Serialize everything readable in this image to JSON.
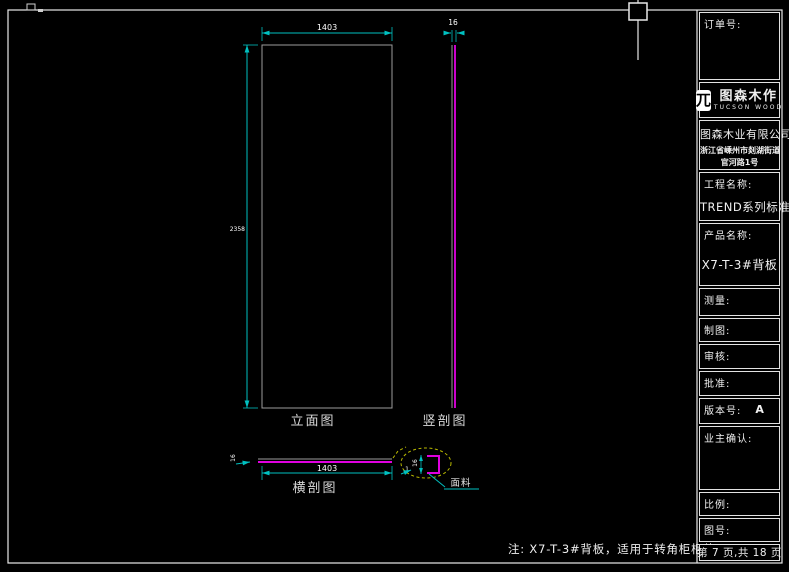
{
  "title_block": {
    "order_label": "订单号:",
    "brand_cn": "图森木作",
    "brand_en": "TUCSON WOOD",
    "logo_glyph": "兀",
    "company_name": "图森木业有限公司",
    "company_address_line1": "浙江省嵊州市剡湖街道",
    "company_address_line2": "官河路1号",
    "project_label": "工程名称:",
    "project_value": "TREND系列标准图",
    "product_label": "产品名称:",
    "product_value": "X7-T-3#背板",
    "measure_label": "测量:",
    "draft_label": "制图:",
    "review_label": "审核:",
    "approve_label": "批准:",
    "version_label": "版本号:",
    "version_value": "A",
    "owner_confirm_label": "业主确认:",
    "scale_label": "比例:",
    "drawing_no_label": "图号:",
    "page_info": "第 7 页,共 18 页"
  },
  "drawing": {
    "elevation": {
      "label": "立面图",
      "width": "1403",
      "height": "2358"
    },
    "vertical_section": {
      "label": "竖剖图",
      "thickness": "16"
    },
    "horizontal_section": {
      "label": "横剖图",
      "width": "1403",
      "thickness": "16"
    },
    "detail": {
      "thickness": "16",
      "edge": "1",
      "material": "面料"
    },
    "note": "注: X7-T-3#背板，适用于转角柜柜体"
  },
  "colors": {
    "dimension": "#00c0c0",
    "section_cut": "#e000e0",
    "outline": "#9c9c9c",
    "detail_dash": "#b8b800",
    "frame": "#e8e8e8"
  }
}
